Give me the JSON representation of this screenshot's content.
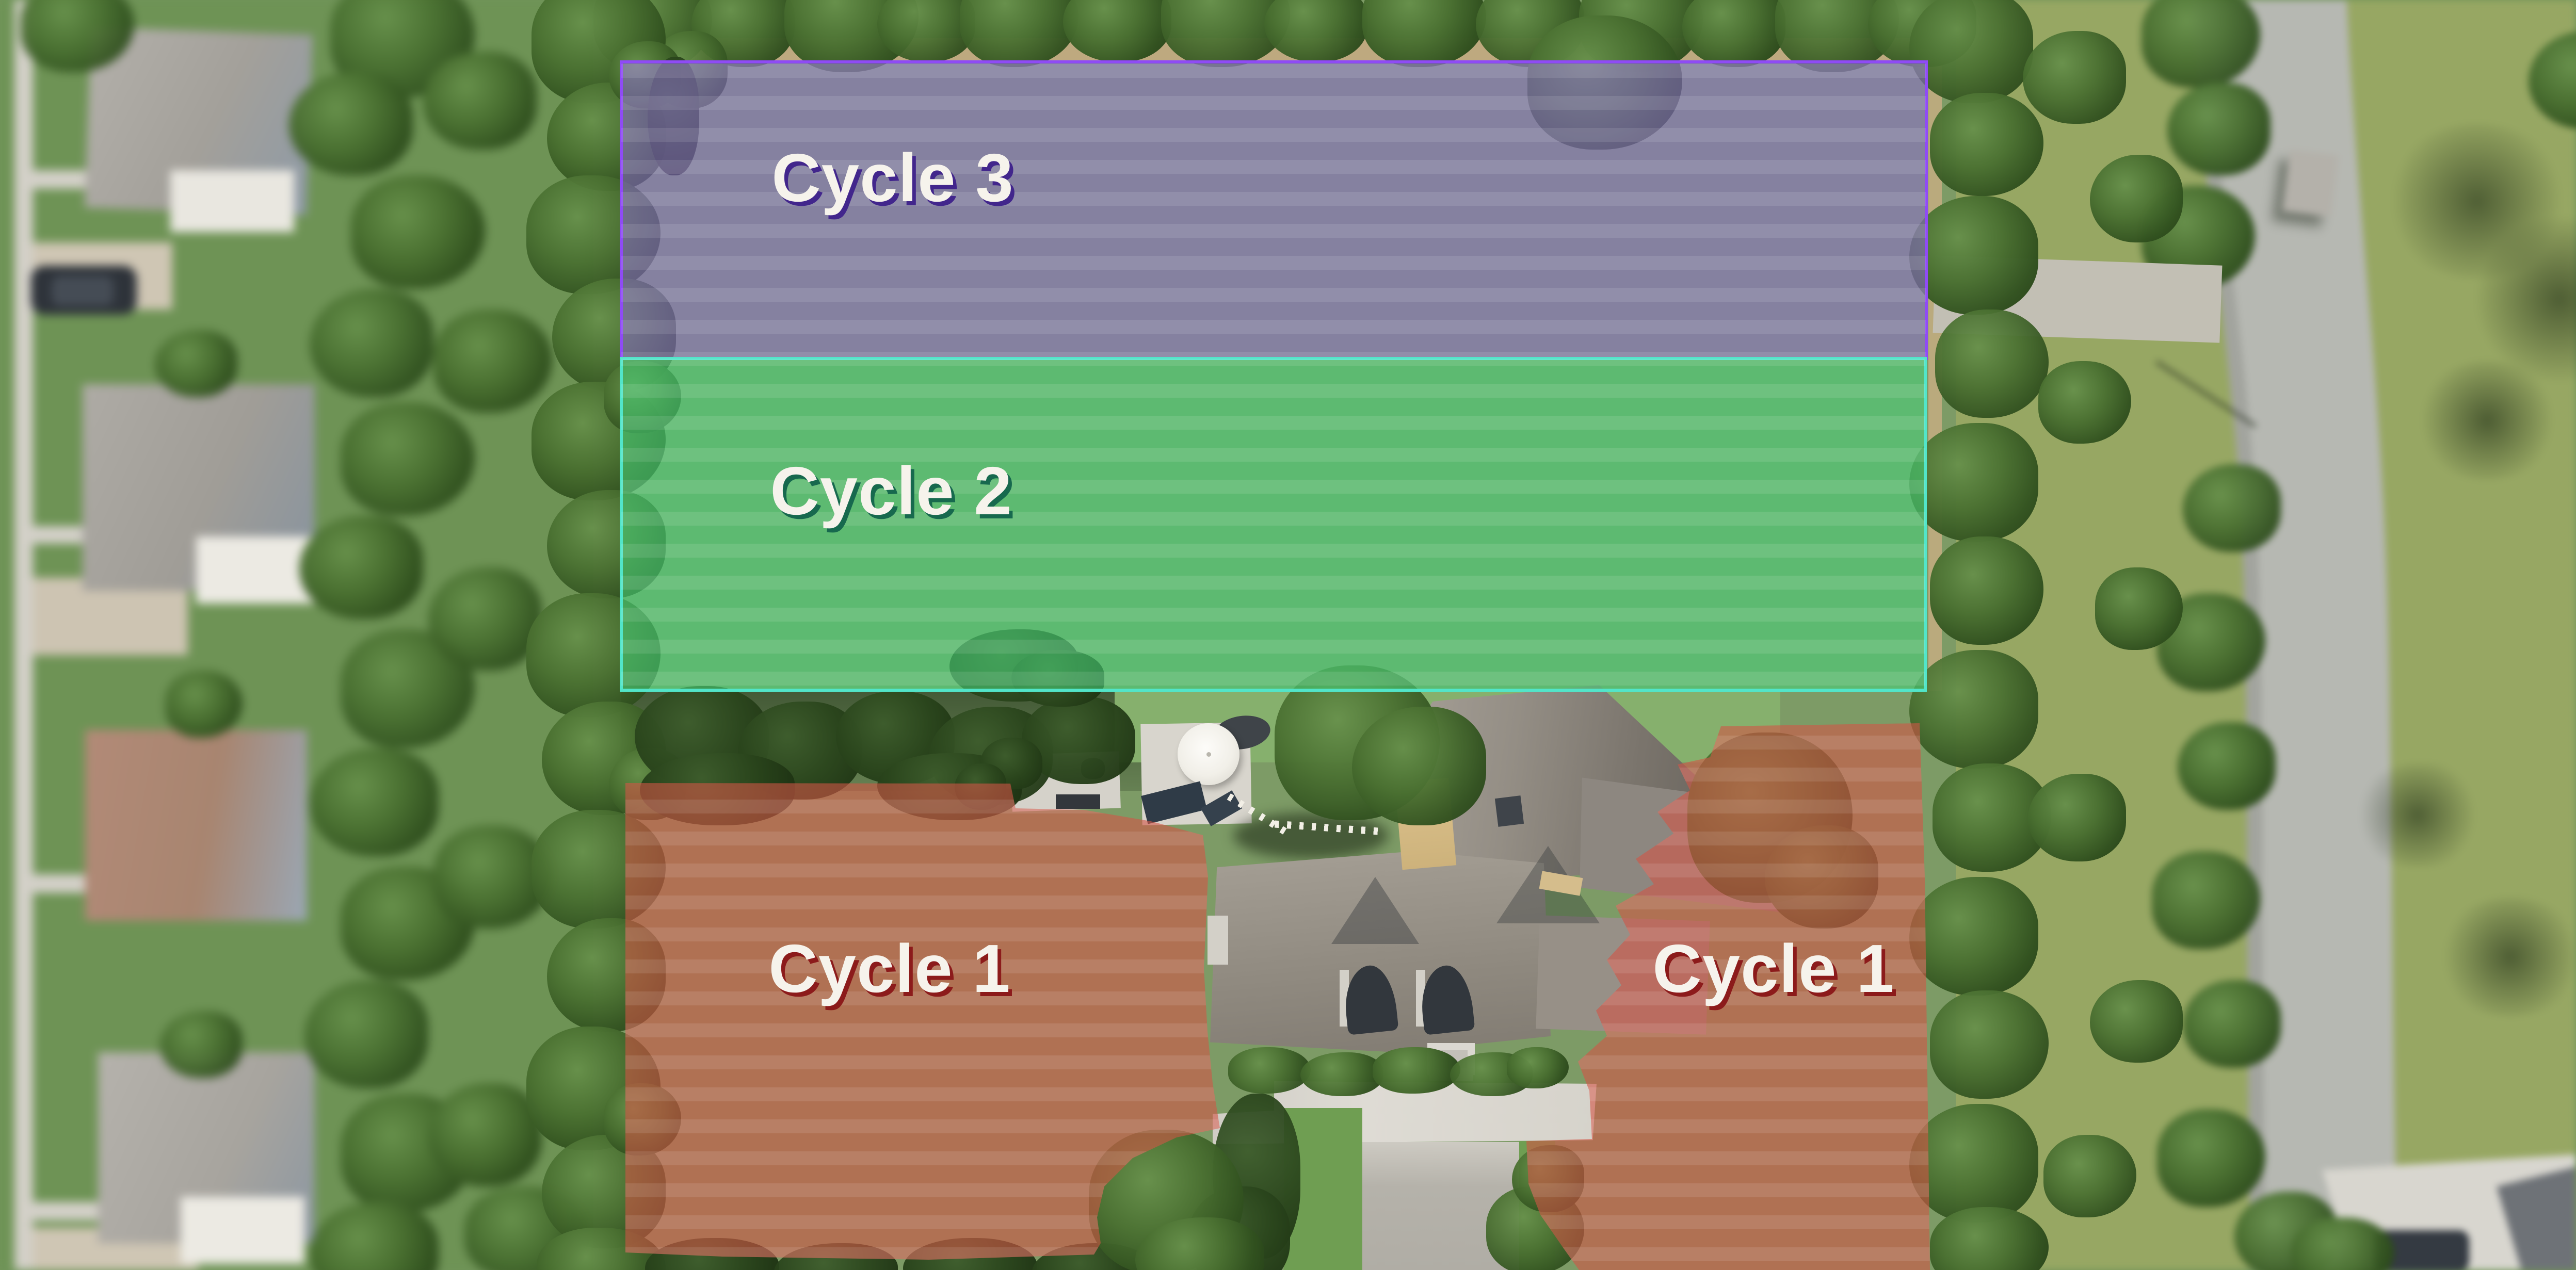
{
  "map": {
    "type": "aerial-lawn-zone-overlay",
    "zones": [
      {
        "id": "cycle-3",
        "label": "Cycle 3",
        "fill": "#8c6bd0",
        "fill_opacity": 0.55,
        "border_color": "#8f4bf5",
        "label_color": "#f6f3ec",
        "label_shadow": "#42268c"
      },
      {
        "id": "cycle-2",
        "label": "Cycle 2",
        "fill": "#46d178",
        "fill_opacity": 0.58,
        "border_color": "#52e5c9",
        "label_color": "#f6f3ec",
        "label_shadow": "#17694e"
      },
      {
        "id": "cycle-1-left",
        "label": "Cycle 1",
        "fill": "#d25546",
        "fill_opacity": 0.6,
        "border_color": null,
        "label_color": "#f6f3ec",
        "label_shadow": "#8c1b1b"
      },
      {
        "id": "cycle-1-right",
        "label": "Cycle 1",
        "fill": "#d25546",
        "fill_opacity": 0.6,
        "border_color": null,
        "label_color": "#f6f3ec",
        "label_shadow": "#8c1b1b"
      }
    ]
  }
}
